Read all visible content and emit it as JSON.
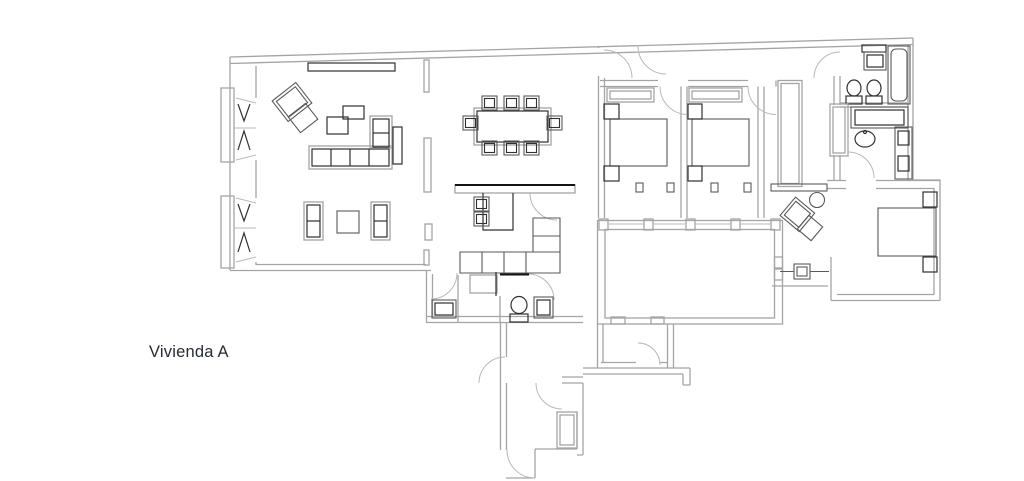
{
  "page": {
    "label": "Vivienda A"
  },
  "theme": {
    "background": "#ffffff",
    "wall": "#a4a4a4",
    "wall_light": "#b8b8b8",
    "furniture": "#5a5a5a",
    "furniture_dark": "#303030",
    "accent_dark": "#121212",
    "label_color": "#272b33"
  }
}
